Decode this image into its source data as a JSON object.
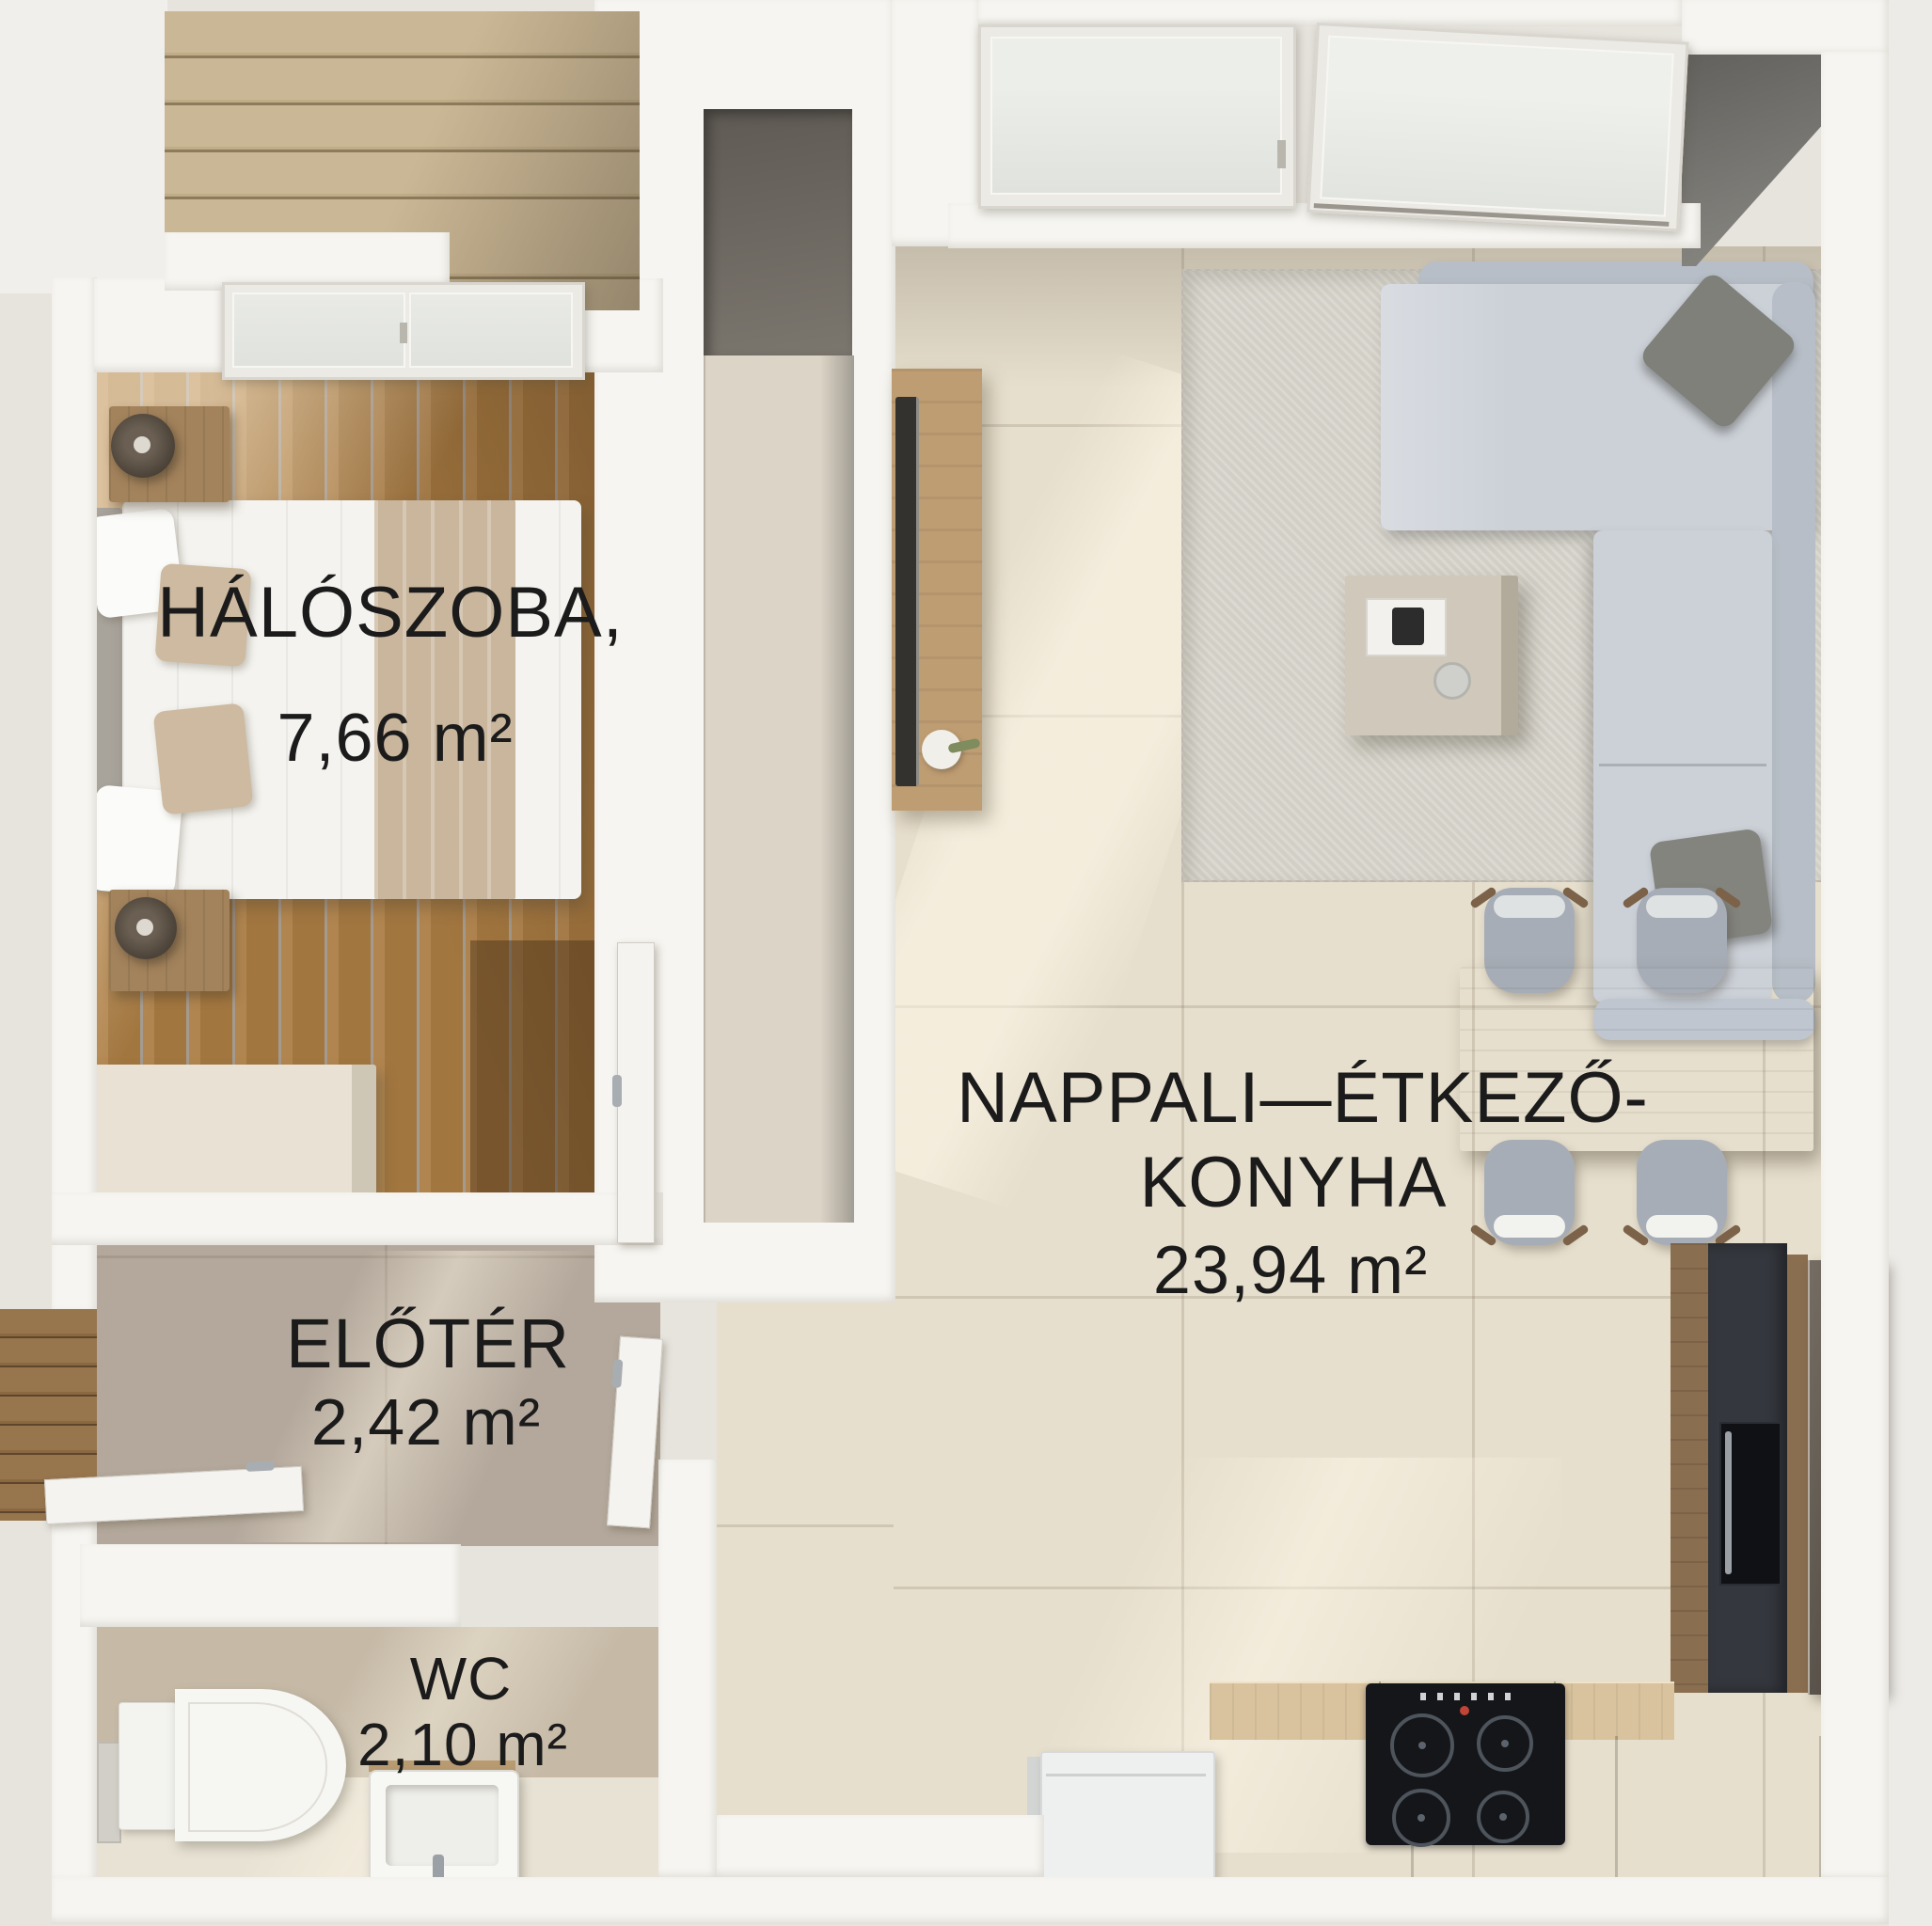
{
  "floor_plan": {
    "rooms": {
      "bedroom": {
        "name": "HÁLÓSZOBA,",
        "area": "7,66 m²"
      },
      "living_kitchen": {
        "name_line1": "NAPPALI—ÉTKEZŐ-",
        "name_line2": "KONYHA",
        "area": "23,94 m²"
      },
      "foyer": {
        "name": "ELŐTÉR",
        "area": "2,42 m²"
      },
      "wc": {
        "name": "WC",
        "area": "2,10 m²"
      }
    },
    "palette": {
      "label_text": "#1b1b1b",
      "wall": "#f6f5f1",
      "bedroom_wood_floor": "#ac7f52",
      "deck_wood": "#c6b392",
      "foyer_floor": "#b3a89b",
      "wc_wall": "#c6baa7",
      "living_floor": "#e7dfcd",
      "rug": "#d2cfc6",
      "sofa": "#ccd1d8",
      "kitchen_dark_units": "#34373d",
      "counter_wood": "#d9c39e",
      "counter_front": "#6b655b",
      "dining_wood": "#c3a884",
      "chair": "#a7adb6",
      "exterior": "#e7e4de"
    }
  }
}
